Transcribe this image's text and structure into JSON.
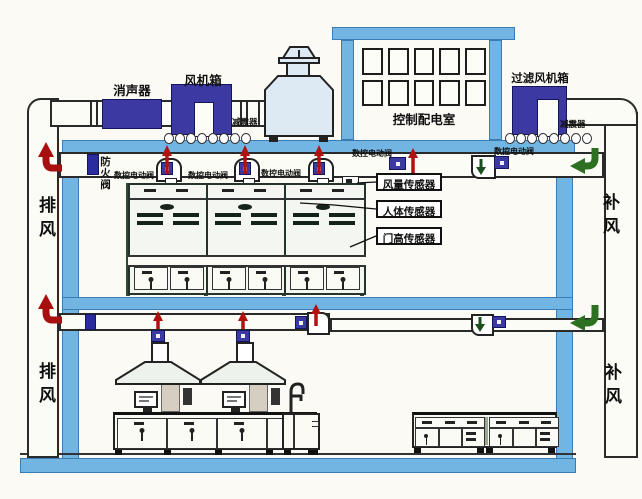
{
  "diagram": {
    "rooftop": {
      "silencer_label": "消声器",
      "fan_box_label": "风机箱",
      "shock_absorber_left_label": "减震器",
      "control_room_label": "控制配电室",
      "filter_fan_box_label": "过滤风机箱",
      "shock_absorber_right_label": "减震器"
    },
    "floor1": {
      "fire_damper_label": "防火阀",
      "valve_labels": [
        "数控电动阀",
        "数控电动阀",
        "数控电动阀",
        "数控电动阀",
        "数控电动阀"
      ],
      "sensor_labels": [
        "风量传感器",
        "人体传感器",
        "门高传感器"
      ]
    },
    "airflow": {
      "exhaust_upper_label": "排风",
      "exhaust_lower_label": "排风",
      "supply_upper_label": "补风",
      "supply_lower_label": "补风"
    }
  },
  "colors": {
    "structure_blue": "#72b4e2",
    "equipment_navy": "#3d39a3",
    "exhaust_arrow_red": "#a81010",
    "supply_arrow_green": "#2e7022"
  }
}
